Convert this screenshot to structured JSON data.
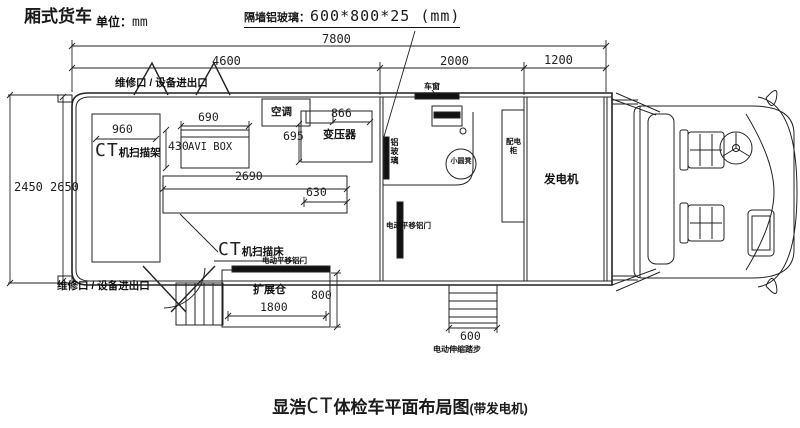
{
  "header": {
    "title": "厢式货车",
    "unit_label": "单位：",
    "unit_value": "mm",
    "glass_label": "隔墙铝玻璃：",
    "glass_value": "600*800*25 (mm)"
  },
  "dims": {
    "overall": "7800",
    "ct_room": "4600",
    "op_room": "2000",
    "gen_room": "1200",
    "body_height": "2450",
    "inner_height": "2650",
    "gantry_width": "960",
    "avi_width": "690",
    "avi_height": "430",
    "trans_width": "866",
    "trans_height": "695",
    "bed_length": "2690",
    "bed_head": "630",
    "expansion_width": "1800",
    "expansion_depth": "800",
    "steps_width": "600"
  },
  "labels": {
    "access_top": "维修口 / 设备进出口",
    "access_bottom": "维修口 / 设备进出口",
    "ct_prefix": "CT",
    "gantry": "机扫描架",
    "bed": "机扫描床",
    "avi_box": "AVI BOX",
    "aircon": "空调",
    "transformer": "变压器",
    "window": "车窗",
    "partition_glass": "铝玻璃",
    "stool": "小圆凳",
    "cabinet": "配电柜",
    "sliding_door": "电动平移铝门",
    "expansion_bay": "扩展仓",
    "telescopic_steps": "电动伸缩踏步",
    "generator": "发电机"
  },
  "caption": {
    "brand": "显浩",
    "ct": "CT",
    "text": "体检车平面布局图",
    "suffix": "(带发电机)"
  }
}
